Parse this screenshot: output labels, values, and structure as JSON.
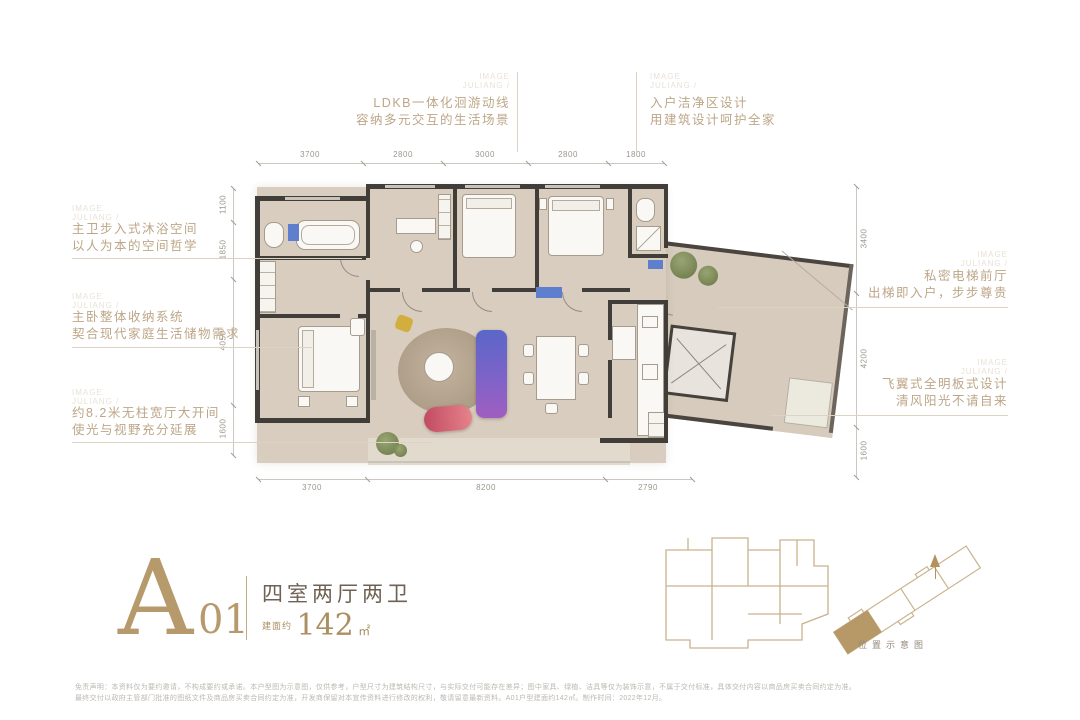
{
  "watermark": {
    "line1": "IMAGE",
    "line2": "JULIANG /"
  },
  "callouts": {
    "top_left": {
      "line1": "LDKB一体化洄游动线",
      "line2": "容纳多元交互的生活场景"
    },
    "top_right": {
      "line1": "入户洁净区设计",
      "line2": "用建筑设计呵护全家"
    },
    "left_1": {
      "line1": "主卫步入式沐浴空间",
      "line2": "以人为本的空间哲学"
    },
    "left_2": {
      "line1": "主卧整体收纳系统",
      "line2": "契合现代家庭生活储物需求"
    },
    "left_3": {
      "line1": "约8.2米无柱宽厅大开间",
      "line2": "使光与视野充分延展"
    },
    "right_1": {
      "line1": "私密电梯前厅",
      "line2": "出梯即入户，步步尊贵"
    },
    "right_2": {
      "line1": "飞翼式全明板式设计",
      "line2": "清风阳光不请自来"
    }
  },
  "dimensions": {
    "top": [
      "3700",
      "2800",
      "3000",
      "2800",
      "1800"
    ],
    "bottom": [
      "3700",
      "8200",
      "2790"
    ],
    "left": [
      "1100",
      "1850",
      "4050",
      "1600"
    ],
    "right": [
      "3400",
      "4200",
      "1600"
    ]
  },
  "title": {
    "letter": "A",
    "number": "01",
    "layout": "四室两厅两卫",
    "area_prefix": "建面约",
    "area_value": "142",
    "area_unit": "㎡"
  },
  "keyplan_caption": "位置示意图",
  "disclaimer": {
    "line1": "免责声明：本资料仅为要约邀请，不构成要约或承诺。本户型图为示意图，仅供参考，户型尺寸为建筑结构尺寸，与实际交付可能存在差异；图中家具、绿植、洁具等仅为装饰示意，不属于交付标准，具体交付内容以商品房买卖合同约定为准。",
    "line2": "最终交付以政府主管部门批准的图纸文件及商品房买卖合同约定为准，开发商保留对本宣传资料进行修改的权利，敬请留意最新资料。A01户型建面约142㎡。制作时间：2022年12月。"
  },
  "colors": {
    "accent_gold": "#b3925f",
    "wall": "#413d38",
    "floor": "#d8cdbe",
    "sofa_gradient_top": "#5a67c8",
    "sofa_gradient_bottom": "#a05ec0",
    "bench_gradient": "#c24b62",
    "accent_blue": "#5d7fce",
    "plant_green": "#6e7c49"
  }
}
